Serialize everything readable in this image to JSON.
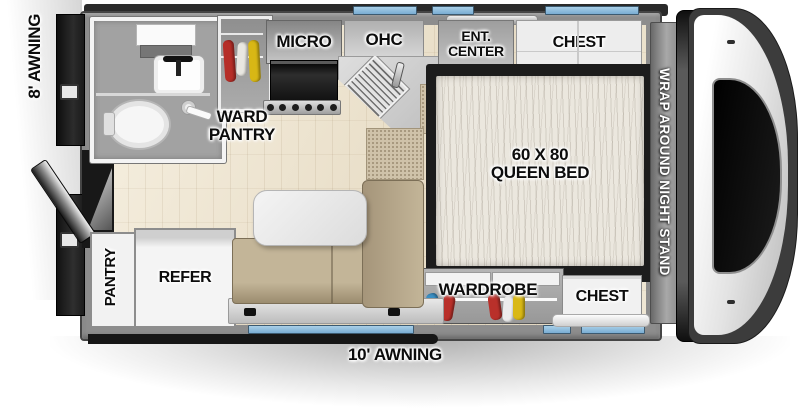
{
  "labels": {
    "awning_left": "8' AWNING",
    "awning_bottom": "10' AWNING",
    "micro": "MICRO",
    "ohc": "OHC",
    "ent_center_line1": "ENT.",
    "ent_center_line2": "CENTER",
    "chest_top": "CHEST",
    "ward_pantry_line1": "WARD",
    "ward_pantry_line2": "PANTRY",
    "bed_line1": "60 X 80",
    "bed_line2": "QUEEN BED",
    "night_stand": "WRAP AROUND NIGHT STAND",
    "wardrobe": "WARDROBE",
    "chest_bottom": "CHEST",
    "pantry": "PANTRY",
    "refer": "REFER"
  },
  "colors": {
    "window_accent": "#84b7da",
    "wall_gray": "#8d8d8d",
    "roof_dark": "#2a2a2a",
    "sofa_tan": "#b2a284",
    "mattress_cream": "#ebe7de",
    "floor_wood": "#ece3d0",
    "counter_speckle": "#cfc2a9",
    "hanger_red": "#b9302a",
    "hanger_yellow": "#d9b815",
    "hanger_blue": "#3b8fc4",
    "hanger_white": "#ececec",
    "cab_black_windshield": "#0a0a0a"
  }
}
